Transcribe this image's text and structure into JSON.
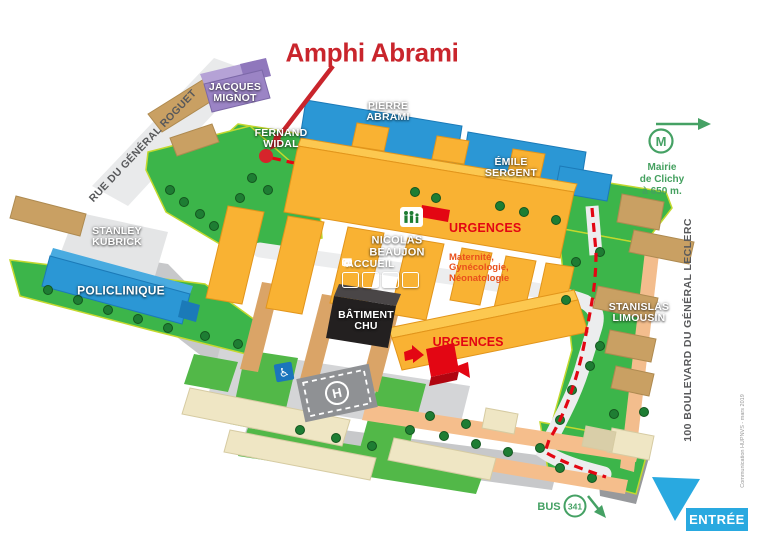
{
  "annotation": {
    "title": "Amphi Abrami"
  },
  "streets": {
    "rue": "RUE DU GÉNÉRAL ROGUET",
    "boulevard": "100 BOULEVARD DU GÉNÉRAL LECLERC"
  },
  "buildings": {
    "jacques_mignot": "JACQUES\nMIGNOT",
    "pierre_abrami": "PIERRE\nABRAMI",
    "fernand_widal": "FERNAND\nWIDAL",
    "emile_sergent": "ÉMILE\nSERGENT",
    "stanley_kubrick": "STANLEY\nKUBRICK",
    "policlinique": "POLICLINIQUE",
    "nicolas_beaujon": "NICOLAS\nBEAUJON",
    "accueil": "ACCUEIL",
    "batiment_chu": "BÂTIMENT\nCHU",
    "stanislas_limousin": "STANISLAS\nLIMOUSIN"
  },
  "emergency": {
    "urgences_maternity_title": "URGENCES",
    "urgences_maternity_services": "Maternité,\nGynécologie,\nNéonatologie",
    "urgences_south": "URGENCES"
  },
  "transit": {
    "metro_letter": "M",
    "metro_caption": "Mairie\nde Clichy\nà 650 m.",
    "bus_label": "BUS",
    "bus_line": "341",
    "entrance_label": "ENTRÉE"
  },
  "helipad_letter": "H",
  "credit": "Communication HUPNVS - mars 2019",
  "colors": {
    "title_red": "#C9252C",
    "accent_red": "#E30613",
    "campus_green": "#3CB54A",
    "building_yellow": "#F9B233",
    "building_blue": "#2B97D5",
    "building_purple": "#9B84C5",
    "transit_green": "#45A164",
    "entrance_blue": "#29A9E0"
  }
}
